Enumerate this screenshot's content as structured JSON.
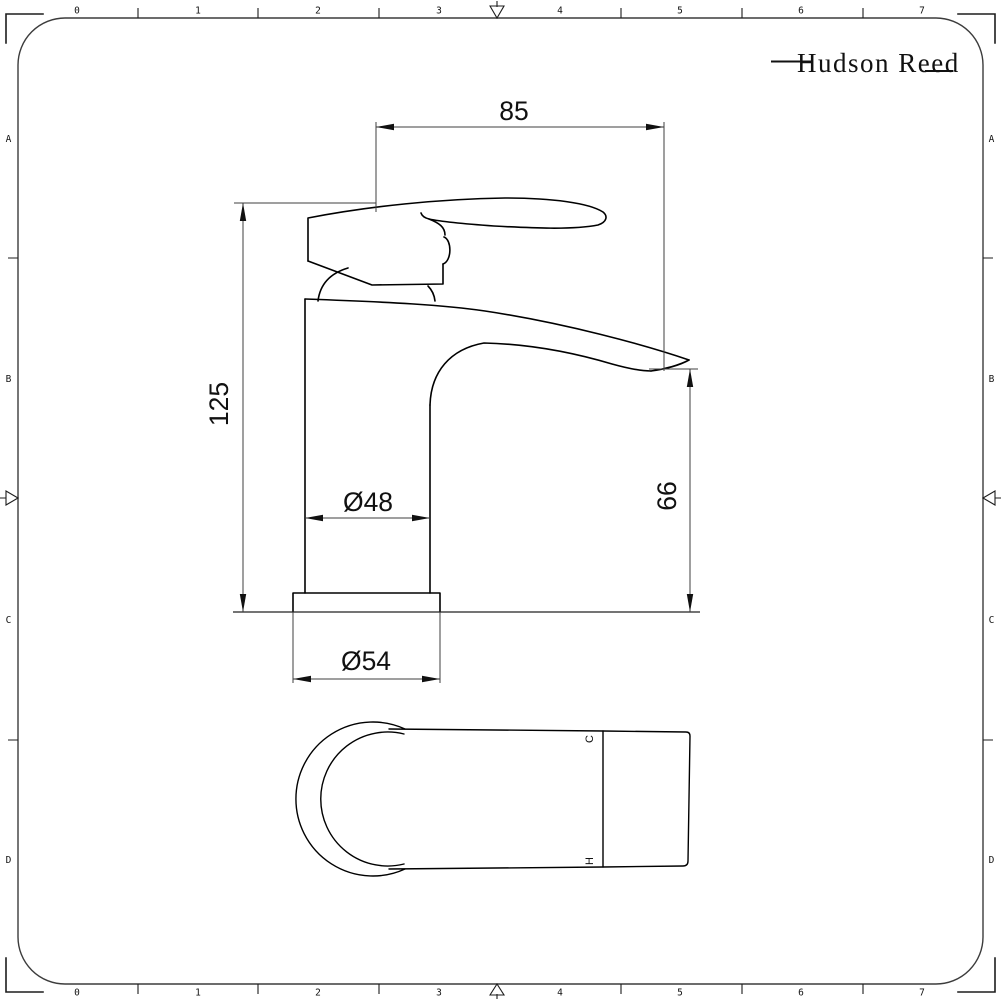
{
  "brand": {
    "name": "Hudson Reed"
  },
  "rulers": {
    "columns": [
      "0",
      "1",
      "2",
      "3",
      "4",
      "5",
      "6",
      "7"
    ],
    "rows": [
      "A",
      "B",
      "C",
      "D"
    ]
  },
  "dimensions": {
    "spout_reach_mm": "85",
    "overall_height_mm": "125",
    "spout_height_mm": "66",
    "body_diameter": "Ø48",
    "base_diameter": "Ø54"
  },
  "plan_view": {
    "cold_label": "C",
    "hot_label": "H"
  },
  "colors": {
    "line": "#000000",
    "dimension_line": "#3f3f3f",
    "background": "#ffffff"
  }
}
